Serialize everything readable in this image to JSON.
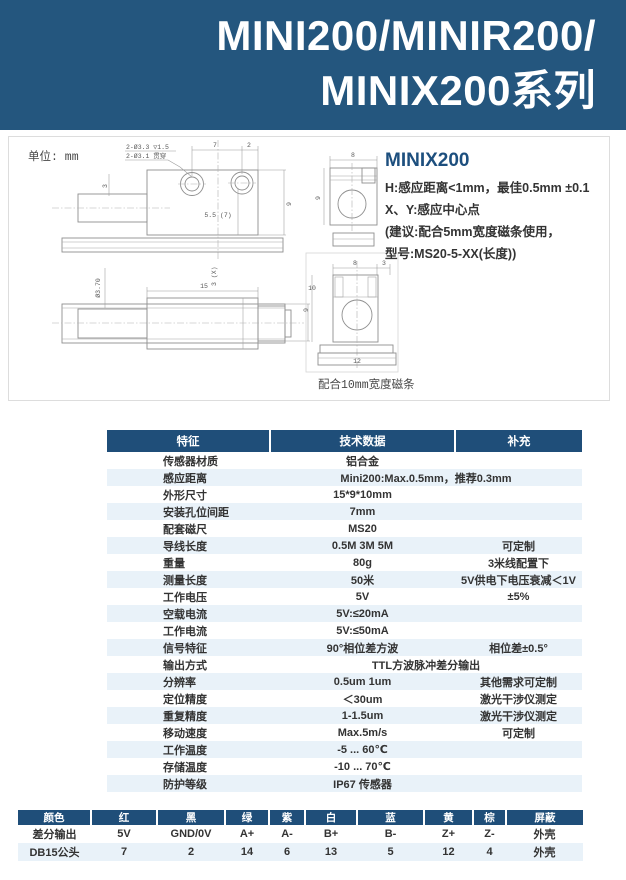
{
  "banner": {
    "line1": "MINI200/MINIR200/",
    "line2": "MINIX200系列"
  },
  "drawing": {
    "unit_label": "单位: mm",
    "top_view": {
      "note1": "2-Ø3.3 ▽1.5",
      "note2": "2-Ø3.1 贯穿",
      "dim_hole_pitch": "7",
      "dim_edge": "2",
      "dim_depth": "5.5 (7)",
      "dim_left": "3",
      "dim_right": "9"
    },
    "side_view": {
      "dim_dia": "Ø3.70",
      "dim_len": "15",
      "dim_x": "3 (X)",
      "dim_h": "10"
    },
    "end_view_top": {
      "dim_w": "8",
      "dim_h": "9"
    },
    "end_view_bottom": {
      "dim_w": "8",
      "dim_n": "3",
      "dim_h": "9",
      "dim_base": "12",
      "caption": "配合10mm宽度磁条"
    },
    "product_note": {
      "title": "MINIX200",
      "line1": "H:感应距离<1mm，最佳0.5mm ±0.1",
      "line2": "X、Y:感应中心点",
      "line3": "(建议:配合5mm宽度磁条使用，",
      "line4": "型号:MS20-5-XX(长度))"
    }
  },
  "spec_table": {
    "headers": [
      "特征",
      "技术数据",
      "补充"
    ],
    "rows": [
      {
        "feature": "传感器材质",
        "tech": "铝合金",
        "supp": "",
        "span": false
      },
      {
        "feature": "感应距离",
        "tech": "Mini200:Max.0.5mm，推荐0.3mm",
        "supp": "",
        "span": true
      },
      {
        "feature": "外形尺寸",
        "tech": "15*9*10mm",
        "supp": "",
        "span": false
      },
      {
        "feature": "安装孔位间距",
        "tech": "7mm",
        "supp": "",
        "span": false
      },
      {
        "feature": "配套磁尺",
        "tech": "MS20",
        "supp": "",
        "span": false
      },
      {
        "feature": "导线长度",
        "tech": "0.5M 3M 5M",
        "supp": "可定制",
        "span": false
      },
      {
        "feature": "重量",
        "tech": "80g",
        "supp": "3米线配置下",
        "span": false
      },
      {
        "feature": "测量长度",
        "tech": "50米",
        "supp": "5V供电下电压衰减＜1V",
        "span": false
      },
      {
        "feature": "工作电压",
        "tech": "5V",
        "supp": "±5%",
        "span": false
      },
      {
        "feature": "空载电流",
        "tech": "5V:≤20mA",
        "supp": "",
        "span": false
      },
      {
        "feature": "工作电流",
        "tech": "5V:≤50mA",
        "supp": "",
        "span": false
      },
      {
        "feature": "信号特征",
        "tech": "90°相位差方波",
        "supp": "相位差±0.5°",
        "span": false
      },
      {
        "feature": "输出方式",
        "tech": "TTL方波脉冲差分输出",
        "supp": "",
        "span": true
      },
      {
        "feature": "分辨率",
        "tech": "0.5um 1um",
        "supp": "其他需求可定制",
        "span": false
      },
      {
        "feature": "定位精度",
        "tech": "＜30um",
        "supp": "激光干涉仪测定",
        "span": false
      },
      {
        "feature": "重复精度",
        "tech": "1-1.5um",
        "supp": "激光干涉仪测定",
        "span": false
      },
      {
        "feature": "移动速度",
        "tech": "Max.5m/s",
        "supp": "可定制",
        "span": false
      },
      {
        "feature": "工作温度",
        "tech": "-5 ... 60℃",
        "supp": "",
        "span": false
      },
      {
        "feature": "存储温度",
        "tech": "-10 ... 70℃",
        "supp": "",
        "span": false
      },
      {
        "feature": "防护等级",
        "tech": "IP67 传感器",
        "supp": "",
        "span": false
      }
    ]
  },
  "wiring_table": {
    "headers": [
      "颜色",
      "红",
      "黑",
      "绿",
      "紫",
      "白",
      "蓝",
      "黄",
      "棕",
      "屏蔽"
    ],
    "rows": [
      [
        "差分输出",
        "5V",
        "GND/0V",
        "A+",
        "A-",
        "B+",
        "B-",
        "Z+",
        "Z-",
        "外壳"
      ],
      [
        "DB15公头",
        "7",
        "2",
        "14",
        "6",
        "13",
        "5",
        "12",
        "4",
        "外壳"
      ]
    ]
  },
  "colors": {
    "banner_bg": "#24567e",
    "table_header_bg": "#1f4e79",
    "stripe_bg": "#e9f2f9",
    "accent_text": "#1d4f7e",
    "drawing_line": "#8f8f8f"
  }
}
